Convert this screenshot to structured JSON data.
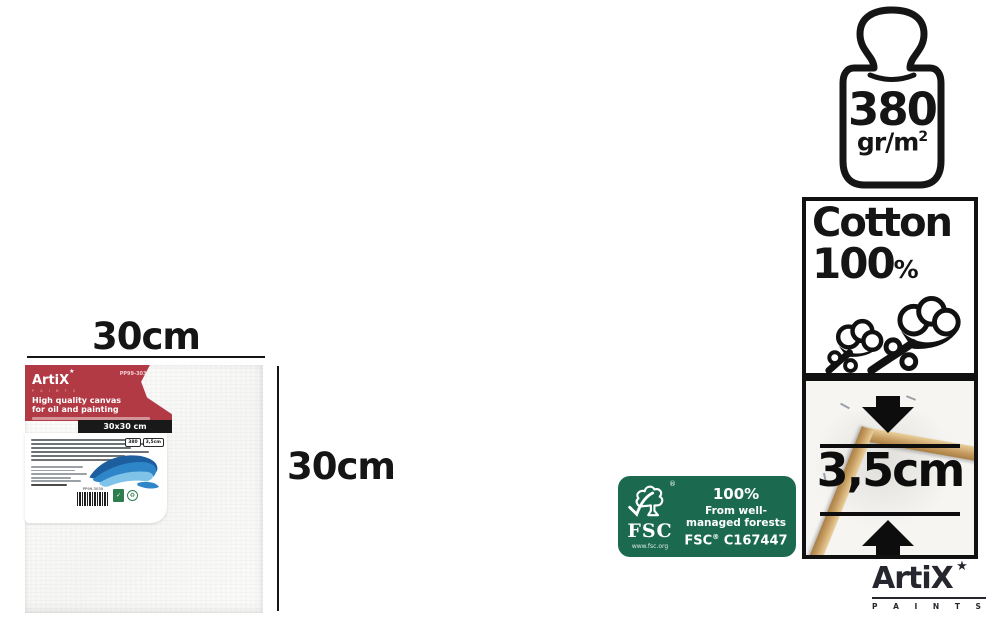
{
  "left_product": {
    "width_label": "30cm",
    "height_label": "30cm",
    "label": {
      "brand": "ArtiX",
      "brand_star": "★",
      "brand_sub": "P A I N T S",
      "product_code": "PP99-3030",
      "title_line1": "High quality canvas",
      "title_line2": "for oil and painting",
      "size_bar": "30x30 cm",
      "mini_badge_weight": "380",
      "mini_badge_depth": "3,5cm",
      "barcode_code": "PP99-3030"
    }
  },
  "spec_icons": {
    "weight": {
      "value": "380",
      "unit_main": "gr/m",
      "unit_sup": "2"
    },
    "cotton": {
      "word": "Cotton",
      "value": "100",
      "percent": "%"
    },
    "depth": {
      "value": "3,5cm"
    }
  },
  "fsc": {
    "acronym": "FSC",
    "registered": "®",
    "website": "www.fsc.org",
    "percent": "100%",
    "desc_line1": "From well-",
    "desc_line2": "managed forests",
    "license_prefix": "FSC",
    "license_reg": "®",
    "license_code": " C167447"
  },
  "footer_logo": {
    "brand": "ArtiX",
    "star": "★",
    "sub": "P A I N T S"
  },
  "colors": {
    "label_red": "#b13a45",
    "bar_black": "#191919",
    "fsc_green": "#1b6a50",
    "wood": "#c49a5e",
    "ink": "#151515"
  }
}
